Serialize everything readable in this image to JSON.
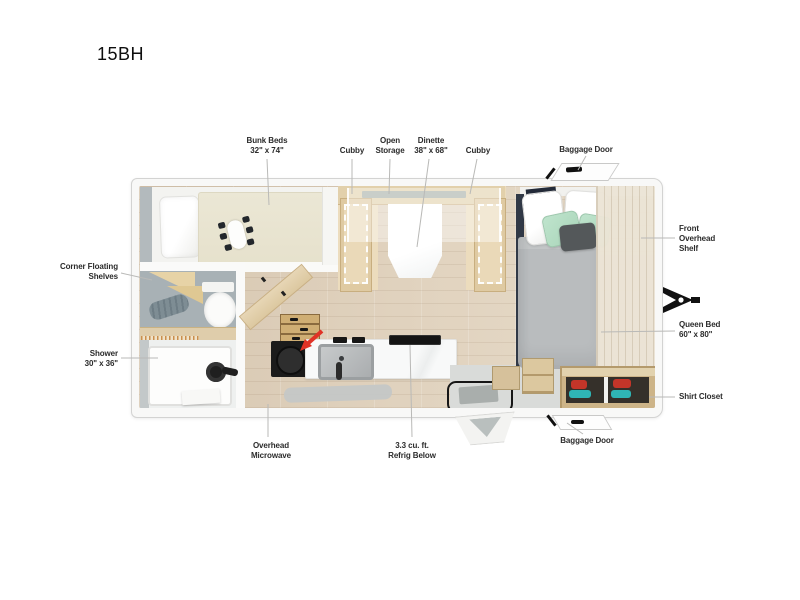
{
  "title": "15BH",
  "callouts": {
    "bunk_beds": "Bunk Beds\n32\" x 74\"",
    "cubby_left": "Cubby",
    "open_storage": "Open\nStorage",
    "dinette": "Dinette\n38\" x 68\"",
    "cubby_right": "Cubby",
    "baggage_door_top": "Baggage Door",
    "front_overhead_shelf": "Front\nOverhead\nShelf",
    "queen_bed": "Queen Bed\n60\" x 80\"",
    "shirt_closet": "Shirt Closet",
    "corner_floating_shelves": "Corner Floating\nShelves",
    "shower": "Shower\n30\" x 36\"",
    "overhead_microwave": "Overhead\nMicrowave",
    "refrig_below": "3.3 cu. ft.\nRefrig Below",
    "baggage_door_bottom": "Baggage Door"
  },
  "colors": {
    "arrow_accent": "#e03226",
    "wood_light": "#e2d0ab",
    "wall_white": "#f8f8f7",
    "bath_wall": "#a8b1b5",
    "duvet_gray": "#b9bcbe",
    "pillow_mint": "#b4ddc4",
    "shoe_red": "#c43529",
    "shoe_teal": "#2fb5b5",
    "leader_line": "#b9b9b7"
  }
}
